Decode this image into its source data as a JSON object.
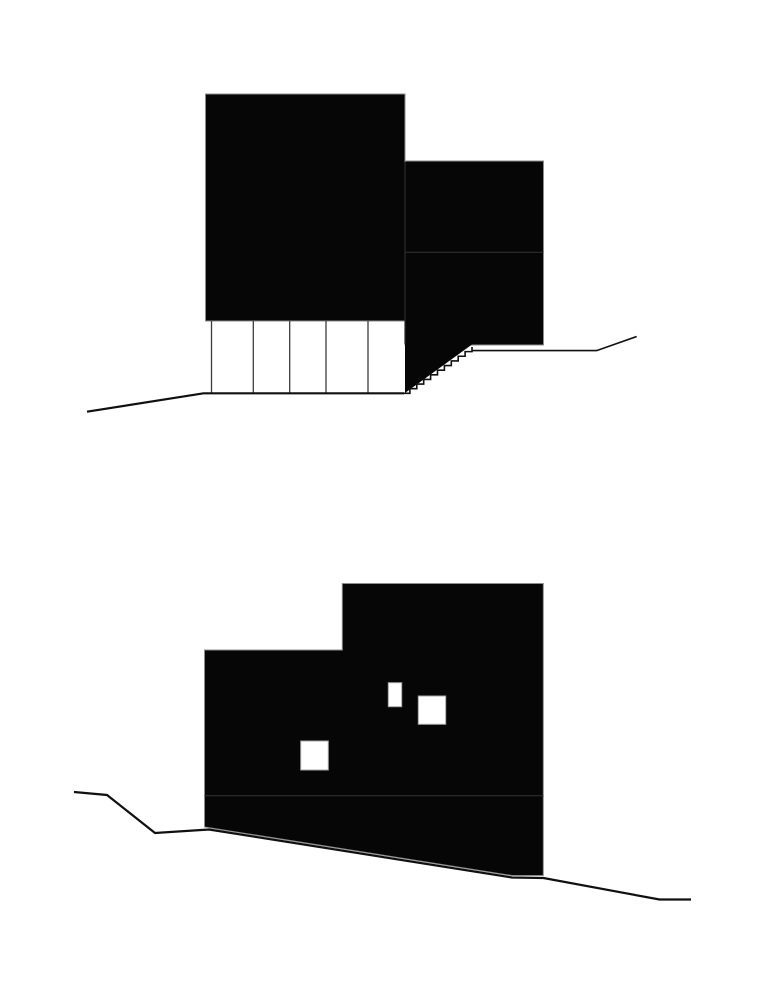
{
  "canvas": {
    "width": 775,
    "height": 1000,
    "background": "#ffffff"
  },
  "palette": {
    "ink": "#060606",
    "seam": "#2d2d2d",
    "column_line": "#3d3d3d",
    "ground": "#101010",
    "volume_edge": "#8c8c8c",
    "window_fill": "#ffffff",
    "window_edge": "#a6a6a6"
  },
  "diagrams": [
    {
      "id": "upper",
      "label": "upper-elevation-section",
      "shapes": [
        {
          "kind": "rect",
          "name": "main-volume",
          "x": 205.5,
          "y": 94,
          "w": 199.5,
          "h": 227,
          "fill": "ink",
          "stroke": "volume_edge",
          "sw": 1
        },
        {
          "kind": "rect",
          "name": "side-volume",
          "x": 405,
          "y": 161,
          "w": 138.5,
          "h": 184,
          "fill": "ink",
          "stroke": "volume_edge",
          "sw": 1
        },
        {
          "kind": "polygon",
          "name": "stair-wedge",
          "points": "405,344 472,344.5 405,393",
          "fill": "ink"
        },
        {
          "kind": "line",
          "name": "volume-seam-vertical",
          "x1": 405,
          "y1": 162,
          "x2": 405,
          "y2": 344,
          "stroke": "seam",
          "sw": 1.2
        },
        {
          "kind": "line",
          "name": "volume-seam-horizontal",
          "x1": 405.5,
          "y1": 252.3,
          "x2": 543.3,
          "y2": 252.3,
          "stroke": "seam",
          "sw": 1.2
        },
        {
          "kind": "line",
          "name": "pilotis-column-1",
          "x1": 211.5,
          "y1": 321,
          "x2": 211.5,
          "y2": 393,
          "stroke": "column_line",
          "sw": 1.3
        },
        {
          "kind": "line",
          "name": "pilotis-column-2",
          "x1": 253.3,
          "y1": 321,
          "x2": 253.3,
          "y2": 393,
          "stroke": "column_line",
          "sw": 1.3
        },
        {
          "kind": "line",
          "name": "pilotis-column-3",
          "x1": 289.7,
          "y1": 321,
          "x2": 289.7,
          "y2": 393,
          "stroke": "column_line",
          "sw": 1.3
        },
        {
          "kind": "line",
          "name": "pilotis-column-4",
          "x1": 326,
          "y1": 321,
          "x2": 326,
          "y2": 393,
          "stroke": "column_line",
          "sw": 1.3
        },
        {
          "kind": "line",
          "name": "pilotis-column-5",
          "x1": 368,
          "y1": 321,
          "x2": 368,
          "y2": 393,
          "stroke": "column_line",
          "sw": 1.3
        },
        {
          "kind": "path",
          "name": "ground-line-left",
          "d": "M87 411.7 L203.5 393.3 H404",
          "stroke": "ground",
          "sw": 2.2
        },
        {
          "kind": "path",
          "name": "stair-steps-and-ground-right",
          "d": "M403 393.3 h6.9 v-4.63 h6.9 v-4.63 h6.9 v-4.63 h6.9 v-4.63 h6.9 v-4.63 h6.9 v-4.63 h6.9 v-4.63 h6.9 v-4.63 h6.9 v-4.63 h6.9 v-4.63 v3.6 H596.7 L636.7 336.5",
          "stroke": "ground",
          "sw": 1.6
        }
      ]
    },
    {
      "id": "lower",
      "label": "lower-elevation-section",
      "shapes": [
        {
          "kind": "polygon",
          "name": "building-mass",
          "points": "204.5,650 342.3,650 342.3,583.5 543.3,583.5 543.3,875.5 511.7,875.5 204.5,827",
          "fill": "ink",
          "stroke": "volume_edge",
          "sw": 1
        },
        {
          "kind": "line",
          "name": "floor-seam-horizontal",
          "x1": 204.5,
          "y1": 795.7,
          "x2": 543.3,
          "y2": 795.7,
          "stroke": "seam",
          "sw": 1.2
        },
        {
          "kind": "rect",
          "name": "window-1",
          "x": 388.3,
          "y": 682.7,
          "w": 13.4,
          "h": 24,
          "fill": "window_fill",
          "stroke": "window_edge",
          "sw": 1
        },
        {
          "kind": "rect",
          "name": "window-2",
          "x": 418.3,
          "y": 696,
          "w": 27.4,
          "h": 28.3,
          "fill": "window_fill",
          "stroke": "window_edge",
          "sw": 1
        },
        {
          "kind": "rect",
          "name": "window-3",
          "x": 300.7,
          "y": 741,
          "w": 27.6,
          "h": 29,
          "fill": "window_fill",
          "stroke": "window_edge",
          "sw": 1
        },
        {
          "kind": "path",
          "name": "ground-line-slope",
          "d": "M74 792 L107 795 L155 833 L209 829.5 L512 877.5 L543.5 878 L659.5 899.5 H691",
          "stroke": "ground",
          "sw": 2.2
        }
      ]
    }
  ]
}
